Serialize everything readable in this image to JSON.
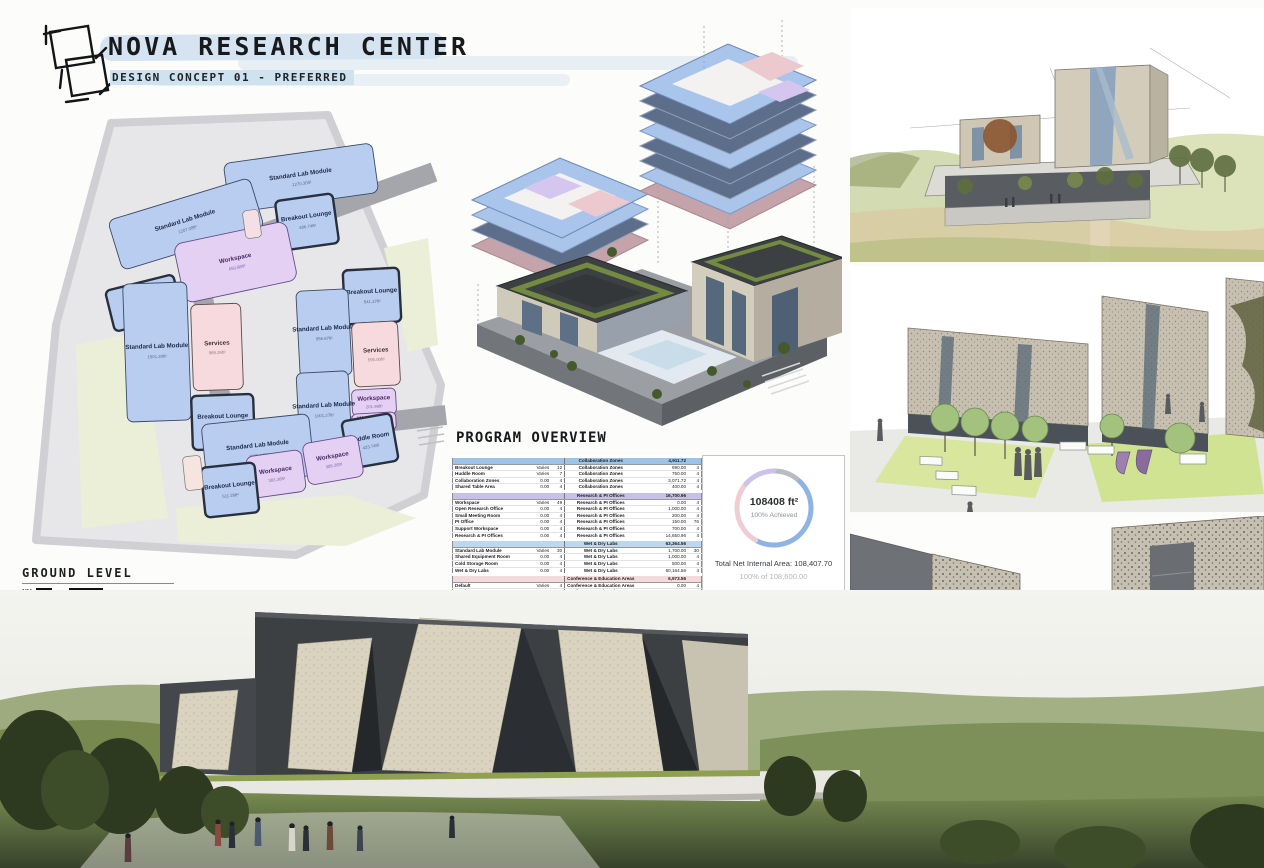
{
  "header": {
    "title": "NOVA RESEARCH CENTER",
    "subtitle": "DESIGN CONCEPT 01 - PREFERRED"
  },
  "plan": {
    "title": "GROUND LEVEL",
    "scale": "1/64",
    "colors": {
      "lab": "#b9cdf0",
      "workspace": "#e3d0f3",
      "services": "#f6dade",
      "site": "#e7e7ea",
      "courtyard": "#ebefd8",
      "circulation": "#a5a5ac"
    },
    "rooms": [
      {
        "name": "Standard Lab Module",
        "area": "1270.30ft²"
      },
      {
        "name": "Standard Lab Module",
        "area": "1207.08ft²"
      },
      {
        "name": "Breakout Lounge",
        "area": "486.74ft²"
      },
      {
        "name": "Huddle Room",
        "area": "387.03ft²"
      },
      {
        "name": "Workspace",
        "area": "650.88ft²"
      },
      {
        "name": "Services",
        "area": "989.26ft²"
      },
      {
        "name": "Standard Lab Module",
        "area": "1501.20ft²"
      },
      {
        "name": "Breakout Lounge",
        "area": "458.73ft²"
      },
      {
        "name": "Breakout Lounge",
        "area": "541.27ft²"
      },
      {
        "name": "Standard Lab Module",
        "area": "956.87ft²"
      },
      {
        "name": "Services",
        "area": "595.00ft²"
      },
      {
        "name": "Workspace",
        "area": "201.99ft²"
      },
      {
        "name": "Workspace",
        "area": "104.07ft²"
      },
      {
        "name": "Standard Lab Module",
        "area": "1001.27ft²"
      },
      {
        "name": "Standard Lab Module",
        "area": "1190.44ft²"
      },
      {
        "name": "Huddle Room",
        "area": "423.74ft²"
      },
      {
        "name": "Workspace",
        "area": "385.26ft²"
      },
      {
        "name": "Workspace",
        "area": "383.36ft²"
      },
      {
        "name": "Breakout Lounge",
        "area": "511.26ft²"
      }
    ]
  },
  "program": {
    "heading": "PROGRAM OVERVIEW",
    "groups": [
      {
        "zone": "Collaboration Zones",
        "total": "4,911.72",
        "color": "#9dc3e6",
        "rows": [
          [
            "Breakout Lounge",
            "Varies",
            "12",
            "Collaboration Zones",
            "690.00",
            "4"
          ],
          [
            "Huddle Room",
            "Varies",
            "7",
            "Collaboration Zones",
            "750.00",
            "4"
          ],
          [
            "Collaboration Zones",
            "0.00",
            "4",
            "Collaboration Zones",
            "3,071.72",
            "4"
          ],
          [
            "Shared Table Area",
            "0.00",
            "4",
            "Collaboration Zones",
            "400.00",
            "4"
          ]
        ]
      },
      {
        "zone": "Research & PI Offices",
        "total": "16,700.96",
        "color": "#c9c0e8",
        "rows": [
          [
            "Workspace",
            "Varies",
            "49",
            "Research & PI Offices",
            "0.00",
            "4"
          ],
          [
            "Open Research Office",
            "0.00",
            "4",
            "Research & PI Offices",
            "1,000.00",
            "4"
          ],
          [
            "Small Meeting Room",
            "0.00",
            "4",
            "Research & PI Offices",
            "200.00",
            "4"
          ],
          [
            "PI Office",
            "0.00",
            "4",
            "Research & PI Offices",
            "150.00",
            "76"
          ],
          [
            "Support Workspace",
            "0.00",
            "4",
            "Research & PI Offices",
            "700.00",
            "4"
          ],
          [
            "Research & PI Offices",
            "0.00",
            "4",
            "Research & PI Offices",
            "14,650.96",
            "4"
          ]
        ]
      },
      {
        "zone": "Wet & Dry Labs",
        "total": "63,364.56",
        "color": "#bdd7ee",
        "rows": [
          [
            "Standard Lab Module",
            "Varies",
            "30",
            "Wet & Dry Labs",
            "1,700.00",
            "30"
          ],
          [
            "Shared Equipment Room",
            "0.00",
            "4",
            "Wet & Dry Labs",
            "1,000.00",
            "4"
          ],
          [
            "Cold Storage Room",
            "0.00",
            "4",
            "Wet & Dry Labs",
            "500.00",
            "4"
          ],
          [
            "Wet & Dry Labs",
            "0.00",
            "4",
            "Wet & Dry Labs",
            "60,164.56",
            "4"
          ]
        ]
      },
      {
        "zone": "Conference & Education Areas",
        "total": "6,973.56",
        "color": "#f3dbdb",
        "rows": [
          [
            "Default",
            "Varies",
            "4",
            "Conference & Education Areas",
            "0.00",
            "4"
          ],
          [
            "Seminar Room",
            "0.00",
            "4",
            "Conference & Education Areas",
            "1,200.00",
            "4"
          ],
          [
            "Classroom",
            "0.00",
            "4",
            "Conference & Education Areas",
            "900.00",
            "4"
          ],
          [
            "AV Room / Control",
            "0.00",
            "4",
            "Conference & Education Areas",
            "300.00",
            "4"
          ],
          [
            "Conference & Education",
            "0.00",
            "4",
            "Conference & Education Areas",
            "3,673.56",
            "4"
          ],
          [
            "Study Lounge",
            "0.00",
            "4",
            "Conference & Education Areas",
            "900.00",
            "4"
          ]
        ]
      }
    ]
  },
  "summary": {
    "value": "108408 ft²",
    "status": "100% Achieved",
    "total": "Total Net Internal Area: 108,407.70",
    "target": "100% of 108,600.00",
    "ring": [
      {
        "color": "#b9bcc0",
        "pct": 12
      },
      {
        "color": "#8fb4e3",
        "pct": 46
      },
      {
        "color": "#f0ccd3",
        "pct": 28
      },
      {
        "color": "#cdc3ea",
        "pct": 14
      }
    ]
  }
}
